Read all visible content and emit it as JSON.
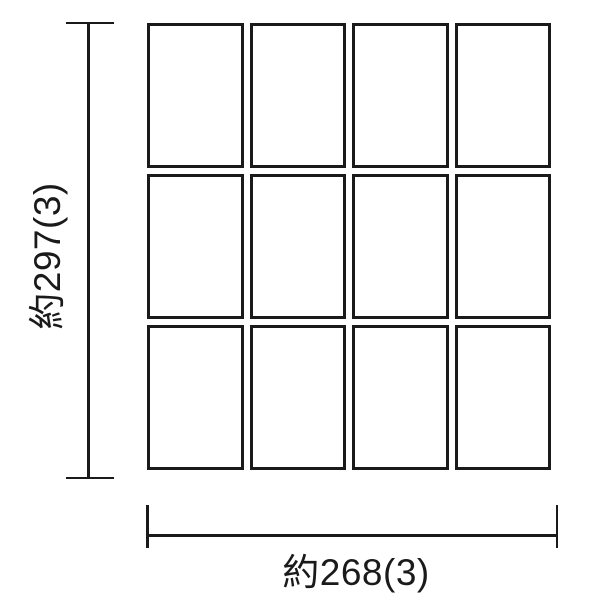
{
  "diagram": {
    "type": "tile-layout-dimension-drawing",
    "grid": {
      "rows": 3,
      "columns": 4,
      "tile_count": 12
    },
    "dimensions": {
      "height_label": "約297(3)",
      "width_label": "約268(3)"
    },
    "colors": {
      "line": "#1a1a1a",
      "background": "#ffffff",
      "tile_fill": "#ffffff"
    }
  }
}
